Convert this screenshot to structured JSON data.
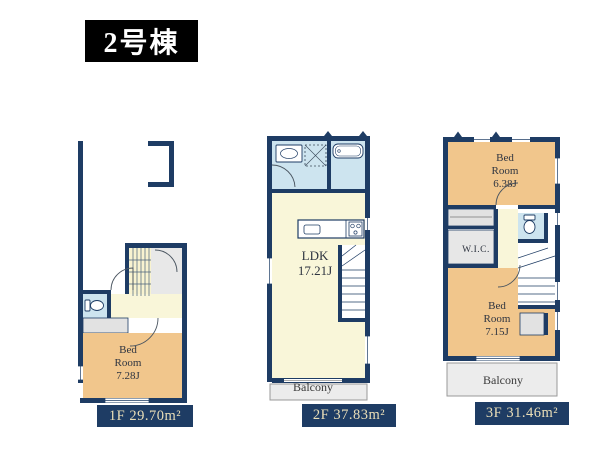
{
  "title": "2号棟",
  "floors": [
    {
      "name": "1F",
      "label": "1F 29.70m²",
      "rooms": {
        "bedroom": "Bed\nRoom\n7.28J"
      }
    },
    {
      "name": "2F",
      "label": "2F 37.83m²",
      "rooms": {
        "ldk": "LDK\n17.21J",
        "balcony": "Balcony"
      }
    },
    {
      "name": "3F",
      "label": "3F 31.46m²",
      "rooms": {
        "bedroom_a": "Bed\nRoom\n6.38J",
        "wic": "W.I.C.",
        "bedroom_b": "Bed\nRoom\n7.15J",
        "balcony": "Balcony"
      }
    }
  ],
  "colors": {
    "wall": "#1e3c64",
    "bedroom_fill": "#f1c68c",
    "living_fill": "#f9f6d9",
    "wet_area_fill": "#cde4ef",
    "closet_fill": "#e2e2e2",
    "balcony_fill": "#ececec",
    "label_bg": "#1e3c64",
    "label_text": "#ebdfb8",
    "title_bg": "#000000",
    "title_text": "#ffffff"
  }
}
